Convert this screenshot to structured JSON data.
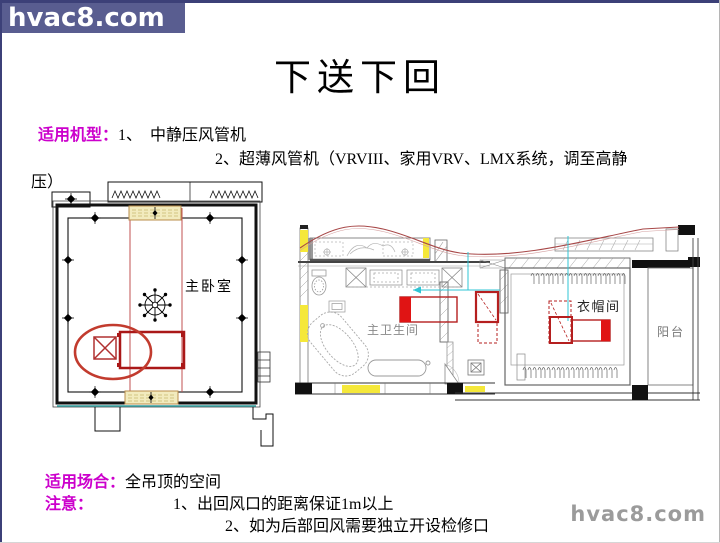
{
  "header": {
    "logo": "hvac8.com"
  },
  "title": "下送下回",
  "machine_type": {
    "label": "适用机型：",
    "item1": "1、  中静压风管机",
    "item2": "2、超薄风管机（VRVIII、家用VRV、LMX系统，调至高静",
    "item2_wrap": "压）"
  },
  "floorplans": {
    "bedroom": {
      "room_label": "主卧室"
    },
    "bathroom": {
      "room_label": "主卫生间",
      "closet_label": "衣帽间",
      "balcony_label": "阳台"
    }
  },
  "footer_notes": {
    "occasion_label": "适用场合：",
    "occasion_value": "全吊顶的空间",
    "note_label": "注意：",
    "note1": "1、出回风口的距离保证1m以上",
    "note2": "2、如为后部回风需要独立开设检修口"
  },
  "watermark": "hvac8.com",
  "colors": {
    "logo_bg": "#595d90",
    "accent_magenta": "#cc00cc",
    "diagram_red": "#cc1111",
    "highlight_yellow": "#f5e83a",
    "flow_cyan": "#2fc4d4"
  }
}
